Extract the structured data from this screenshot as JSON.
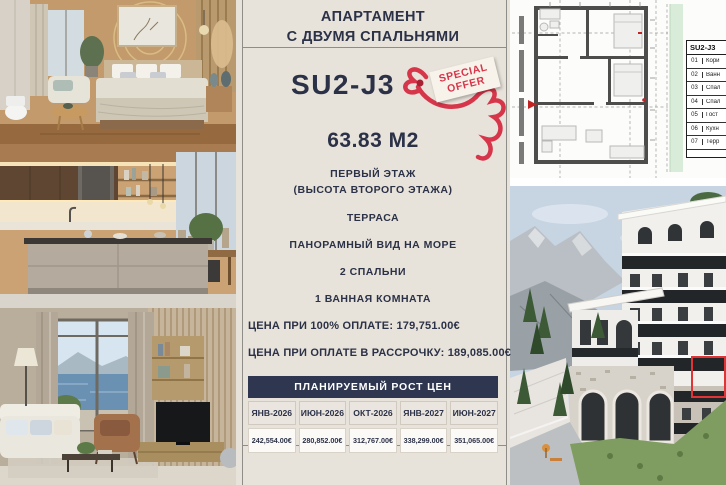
{
  "card": {
    "title_line1": "АПАРТАМЕНТ",
    "title_line2": "С ДВУМЯ СПАЛЬНЯМИ",
    "unit_id": "SU2-J3",
    "offer_badge": {
      "line1": "SPECIAL",
      "line2": "OFFER"
    },
    "area": "63.83 М2",
    "features": [
      "ПЕРВЫЙ ЭТАЖ\n(ВЫСОТА ВТОРОГО ЭТАЖА)",
      "ТЕРРАСА",
      "ПАНОРАМНЫЙ ВИД НА МОРЕ",
      "2 СПАЛЬНИ",
      "1 ВАННАЯ КОМНАТА"
    ],
    "price_full": {
      "label": "ЦЕНА ПРИ 100% ОПЛАТЕ:",
      "value": "179,751.00€"
    },
    "price_installment": {
      "label": "ЦЕНА ПРИ ОПЛАТЕ В РАССРОЧКУ:",
      "value": "189,085.00€"
    },
    "growth_table": {
      "title": "ПЛАНИРУЕМЫЙ РОСТ ЦЕН",
      "columns": [
        "ЯНВ-2026",
        "ИЮН-2026",
        "ОКТ-2026",
        "ЯНВ-2027",
        "ИЮН-2027"
      ],
      "values": [
        "242,554.00€",
        "280,852.00€",
        "312,767.00€",
        "338,299.00€",
        "351,065.00€"
      ]
    }
  },
  "floor_plan_legend": {
    "title": "SU2-J3",
    "rows": [
      {
        "num": "01",
        "name": "Кори"
      },
      {
        "num": "02",
        "name": "Ванн"
      },
      {
        "num": "03",
        "name": "Спал"
      },
      {
        "num": "04",
        "name": "Спал"
      },
      {
        "num": "05",
        "name": "Гост"
      },
      {
        "num": "06",
        "name": "Кухн"
      },
      {
        "num": "07",
        "name": "Терр"
      }
    ]
  },
  "colors": {
    "navy_text": "#2b3147",
    "card_beige": "#e7e2da",
    "offer_red": "#d6354a",
    "table_header_bg": "#2e3650",
    "plan_green_strip": "#d9ecd9",
    "unit_highlight_red": "#e23434"
  }
}
